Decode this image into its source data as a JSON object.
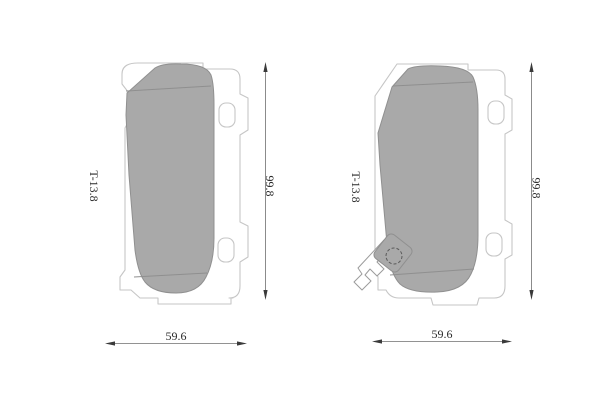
{
  "diagram": {
    "type": "technical-drawing",
    "subject": "disc brake pad set, two pad views with dimension callouts",
    "views": [
      {
        "name": "left-pad",
        "thickness_label": "T-13.8",
        "height_label": "99.8",
        "width_label": "59.6",
        "wear_indicator": false
      },
      {
        "name": "right-pad",
        "thickness_label": "T-13.8",
        "height_label": "99.8",
        "width_label": "59.6",
        "wear_indicator": true
      }
    ],
    "colors": {
      "background": "#ffffff",
      "friction_fill": "#a9a9a9",
      "friction_edge": "#909090",
      "plate_edge": "#c6c6c6",
      "dimension_line": "#6e6e6e",
      "text": "#2a2a2a"
    }
  }
}
